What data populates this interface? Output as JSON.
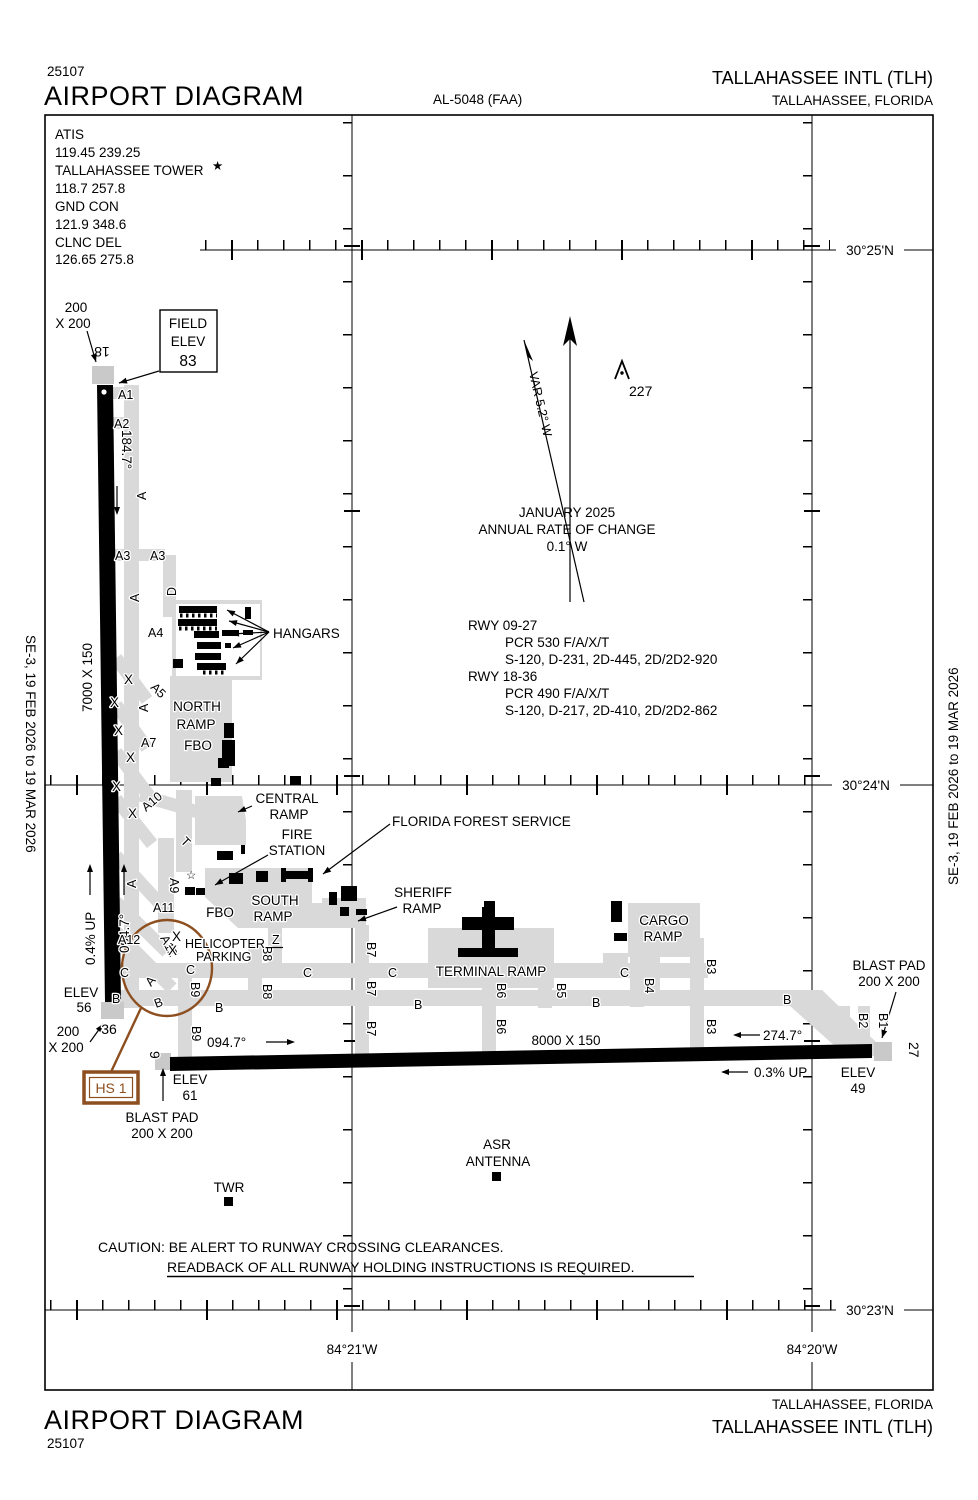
{
  "header": {
    "chart_number": "25107",
    "title": "AIRPORT DIAGRAM",
    "procedure_id": "AL-5048 (FAA)",
    "airport_name": "TALLAHASSEE INTL (TLH)",
    "city": "TALLAHASSEE, FLORIDA"
  },
  "comm": {
    "atis_label": "ATIS",
    "atis_freq": "119.45 239.25",
    "tower_label": "TALLAHASSEE TOWER",
    "tower_star": "★",
    "tower_freq": "118.7 257.8",
    "gnd_label": "GND CON",
    "gnd_freq": "121.9 348.6",
    "clnc_label": "CLNC DEL",
    "clnc_freq": "126.65 275.8"
  },
  "margin": {
    "edition": "SE-3,  19 FEB 2026  to  19 MAR 2026"
  },
  "graticule": {
    "lat_25": "30°25'N",
    "lat_24": "30°24'N",
    "lat_23": "30°23'N",
    "lon_21": "84°21'W",
    "lon_20": "84°20'W"
  },
  "compass": {
    "var_label": "VAR 5.2° W",
    "date": "JANUARY 2025",
    "rate_label": "ANNUAL RATE OF CHANGE",
    "rate_value": "0.1° W"
  },
  "obstruction": {
    "elevation": "227"
  },
  "field_elev": {
    "line1": "FIELD",
    "line2": "ELEV",
    "line3": "83"
  },
  "runway_data": {
    "rwy0927": "RWY 09-27",
    "rwy0927_pcr": "PCR 530 F/A/X/T",
    "rwy0927_strength": "S-120, D-231, 2D-445, 2D/2D2-920",
    "rwy1836": "RWY 18-36",
    "rwy1836_pcr": "PCR 490 F/A/X/T",
    "rwy1836_strength": "S-120, D-217, 2D-410, 2D/2D2-862"
  },
  "rwy1836": {
    "num18": "18",
    "num36": "36",
    "hdg18": "184.7°",
    "hdg36": "004.7°",
    "dim": "7000 X 150",
    "grade": "0.4% UP",
    "elev36_label": "ELEV",
    "elev36_val": "56",
    "blast18_l1": "200",
    "blast18_l2": "X 200",
    "blast36_l1": "200",
    "blast36_l2": "X 200"
  },
  "rwy0927": {
    "num9": "9",
    "num27": "27",
    "hdg9": "094.7°",
    "hdg27": "274.7°",
    "dim": "8000 X 150",
    "grade": "0.3% UP",
    "elev9_label": "ELEV",
    "elev9_val": "61",
    "elev27_label": "ELEV",
    "elev27_val": "49",
    "blast9_l1": "BLAST PAD",
    "blast9_l2": "200 X 200",
    "blast27_l1": "BLAST PAD",
    "blast27_l2": "200 X 200"
  },
  "hotspot": {
    "label": "HS 1",
    "color": "#8d4f1f"
  },
  "facilities": {
    "hangars": "HANGARS",
    "north_l1": "NORTH",
    "north_l2": "RAMP",
    "fbo": "FBO",
    "central_l1": "CENTRAL",
    "central_l2": "RAMP",
    "fire_l1": "FIRE",
    "fire_l2": "STATION",
    "south_l1": "SOUTH",
    "south_l2": "RAMP",
    "sheriff_l1": "SHERIFF",
    "sheriff_l2": "RAMP",
    "ffs": "FLORIDA FOREST SERVICE",
    "terminal": "TERMINAL RAMP",
    "cargo_l1": "CARGO",
    "cargo_l2": "RAMP",
    "heli_l1": "HELICOPTER",
    "heli_l2": "PARKING",
    "twr": "TWR",
    "asr_l1": "ASR",
    "asr_l2": "ANTENNA",
    "star": "☆"
  },
  "taxiways": {
    "A": "A",
    "A1": "A1",
    "A2": "A2",
    "A3": "A3",
    "A4": "A4",
    "A5": "A5",
    "A7": "A7",
    "A9": "A9",
    "A10": "A10",
    "A11": "A11",
    "A12": "A12",
    "B": "B",
    "B1": "B1",
    "B2": "B2",
    "B3": "B3",
    "B4": "B4",
    "B5": "B5",
    "B6": "B6",
    "B7": "B7",
    "B8": "B8",
    "B9": "B9",
    "C": "C",
    "D": "D",
    "T": "T",
    "Z": "Z",
    "X": "X"
  },
  "caution": {
    "line1": "CAUTION: BE ALERT TO RUNWAY CROSSING CLEARANCES.",
    "line2": "READBACK OF ALL RUNWAY HOLDING INSTRUCTIONS IS REQUIRED."
  }
}
